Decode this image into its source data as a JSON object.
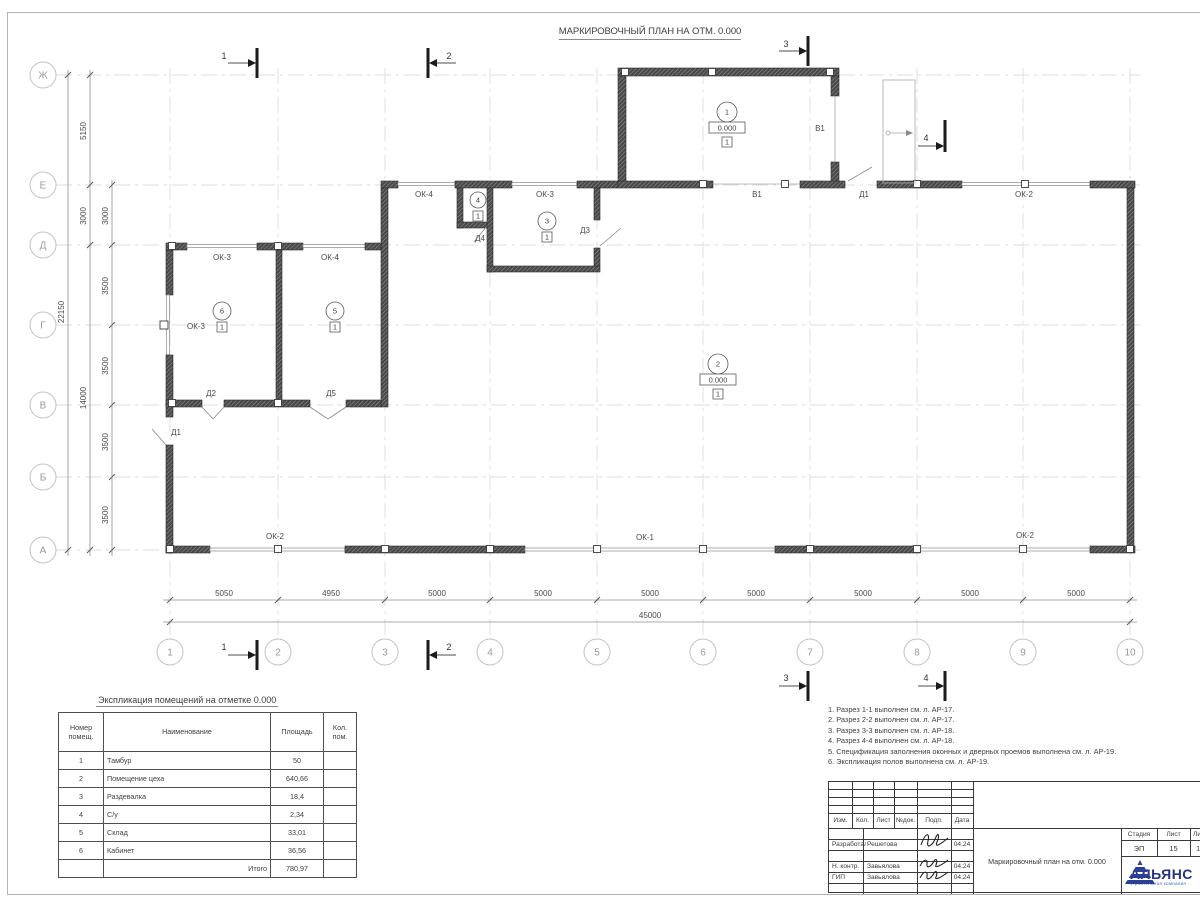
{
  "sheet": {
    "title": "МАРКИРОВОЧНЫЙ ПЛАН НА ОТМ. 0.000"
  },
  "plan": {
    "row_axes": [
      "Ж",
      "Е",
      "Д",
      "Г",
      "В",
      "Б",
      "А"
    ],
    "col_axes": [
      "1",
      "2",
      "3",
      "4",
      "5",
      "6",
      "7",
      "8",
      "9",
      "10"
    ],
    "left_dims": {
      "total": "22150",
      "mid": [
        "5150",
        "3000",
        "14000"
      ],
      "inner": [
        "3000",
        "3500",
        "3500",
        "3500",
        "3500"
      ]
    },
    "bottom_dims": {
      "segments": [
        "5050",
        "4950",
        "5000",
        "5000",
        "5000",
        "5000",
        "5000",
        "5000",
        "5000"
      ],
      "total": "45000"
    },
    "section_marks": [
      "1",
      "2",
      "3",
      "4"
    ],
    "rooms": [
      {
        "num": "1",
        "elev": "0.000",
        "floor": "1"
      },
      {
        "num": "2",
        "elev": "0.000",
        "floor": "1"
      },
      {
        "num": "3",
        "floor": "1"
      },
      {
        "num": "4",
        "floor": "1"
      },
      {
        "num": "5",
        "floor": "1"
      },
      {
        "num": "6",
        "floor": "1"
      }
    ],
    "wall_labels": [
      "ОК-4",
      "ОК-3",
      "В1",
      "Д1",
      "ОК-2",
      "В1",
      "Д4",
      "Д3",
      "ОК-3",
      "ОК-4",
      "ОК-3",
      "Д2",
      "Д5",
      "Д1",
      "ОК-2",
      "ОК-1",
      "ОК-2"
    ]
  },
  "table": {
    "title": "Экспликация помещений на отметке 0.000",
    "headers": {
      "num": "Номер помещ.",
      "name": "Наименование",
      "area": "Площадь",
      "count": "Кол. пом."
    },
    "rows": [
      {
        "num": "1",
        "name": "Тамбур",
        "area": "50"
      },
      {
        "num": "2",
        "name": "Помещение цеха",
        "area": "640,66"
      },
      {
        "num": "3",
        "name": "Раздевалка",
        "area": "18,4"
      },
      {
        "num": "4",
        "name": "С/у",
        "area": "2,34"
      },
      {
        "num": "5",
        "name": "Склад",
        "area": "33,01"
      },
      {
        "num": "6",
        "name": "Кабинет",
        "area": "36,56"
      }
    ],
    "total_label": "Итого",
    "total_value": "780,97"
  },
  "notes": [
    "1. Разрез 1-1 выполнен см. л. АР-17.",
    "2. Разрез 2-2 выполнен см. л. АР-17.",
    "3. Разрез 3-3 выполнен см. л. АР-18.",
    "4. Разрез 4-4 выполнен см. л. АР-18.",
    "5. Спецификация заполнения оконных и дверных проемов выполнена см. л. АР-19.",
    "6. Экспликация полов выполнена см. л. АР-19."
  ],
  "titleblock": {
    "cols": [
      "Изм.",
      "Кол.",
      "Лист",
      "№док.",
      "Подп.",
      "Дата"
    ],
    "rows": [
      {
        "role": "Разработал",
        "name": "Решетова",
        "date": "04.24"
      },
      {
        "role": "Н. контр.",
        "name": "Завьялова",
        "date": "04.24"
      },
      {
        "role": "ГИП",
        "name": "Завьялова",
        "date": "04.24"
      }
    ],
    "doc_title": "Маркировочный план на отм. 0.000",
    "stage_label": "Стадия",
    "stage": "ЭП",
    "sheet_label": "Лист",
    "sheet": "15",
    "sheets_label": "Листов",
    "sheets": "1"
  },
  "logo": {
    "name": "АЛЬЯНС",
    "subtitle": "строительная компания"
  }
}
